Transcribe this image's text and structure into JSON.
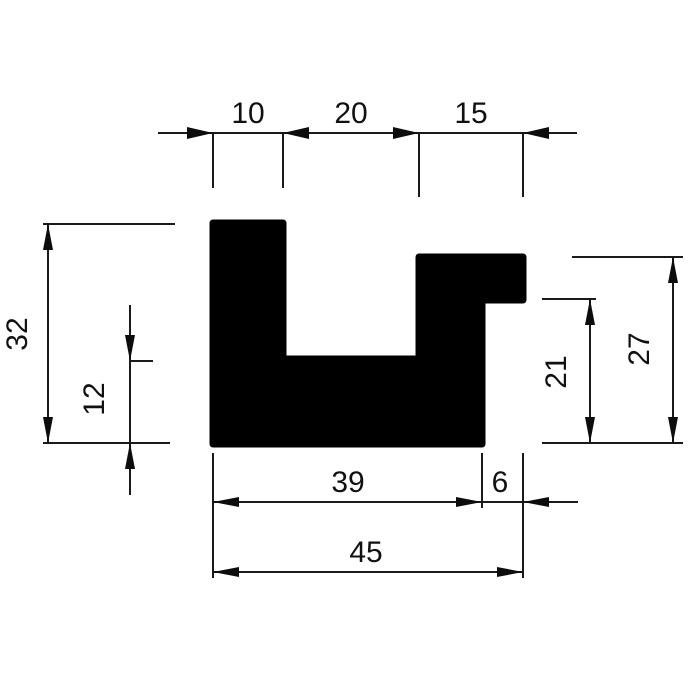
{
  "drawing": {
    "kind": "technical cross-section drawing",
    "shape": "U-channel profile with stepped right flange",
    "colors": {
      "background": "#ffffff",
      "profile_fill": "#000000",
      "line_color": "#1a1a1a",
      "text_color": "#111111"
    },
    "dimensions": {
      "top_left_flange_width": {
        "label": "10",
        "value": 10
      },
      "top_channel_width": {
        "label": "20",
        "value": 20
      },
      "top_right_flange_width": {
        "label": "15",
        "value": 15
      },
      "left_overall_height": {
        "label": "32",
        "value": 32
      },
      "base_thickness": {
        "label": "12",
        "value": 12
      },
      "right_step_height": {
        "label": "21",
        "value": 21
      },
      "right_overall_height": {
        "label": "27",
        "value": 27
      },
      "bottom_body_width": {
        "label": "39",
        "value": 39
      },
      "bottom_notch_width": {
        "label": "6",
        "value": 6
      },
      "bottom_total_width": {
        "label": "45",
        "value": 45
      }
    }
  }
}
